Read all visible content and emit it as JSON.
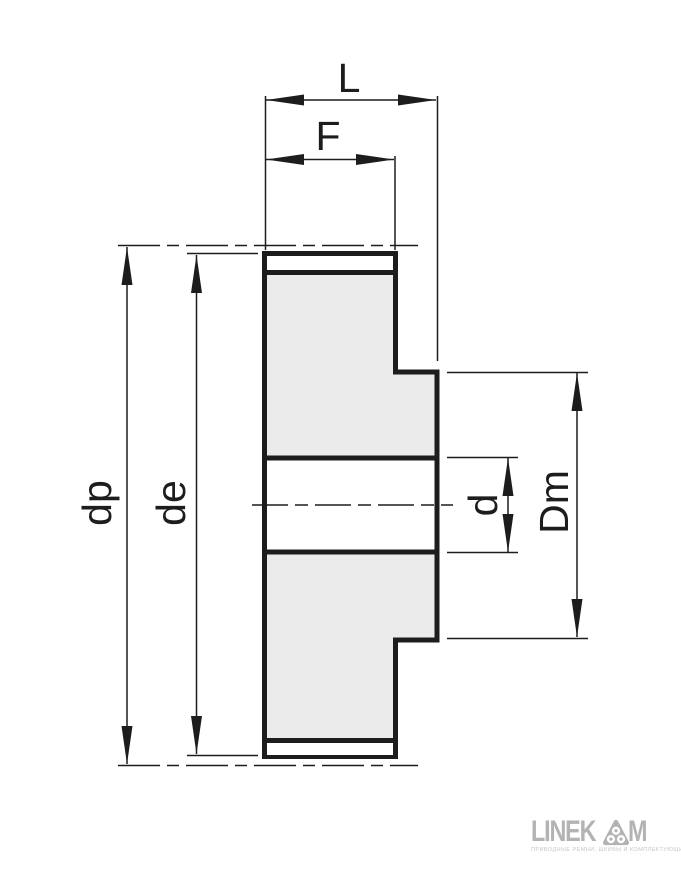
{
  "drawing": {
    "type": "timing-pulley-cross-section",
    "labels": {
      "overall_width": "L",
      "face_width": "F",
      "pitch_diameter": "dp",
      "outside_diameter": "de",
      "bore_diameter": "d",
      "hub_diameter": "Dm"
    }
  },
  "colors": {
    "line": "#1d1d1d",
    "part_fill": "#ebebeb",
    "logo_gray": "#b3b3b3"
  },
  "logo": {
    "wordmark_left": "LINEK",
    "wordmark_right": "M",
    "tagline": "ПРИВОДНЫЕ РЕМНИ, ШКИВЫ И КОМПЛЕКТУЮЩИЕ"
  }
}
